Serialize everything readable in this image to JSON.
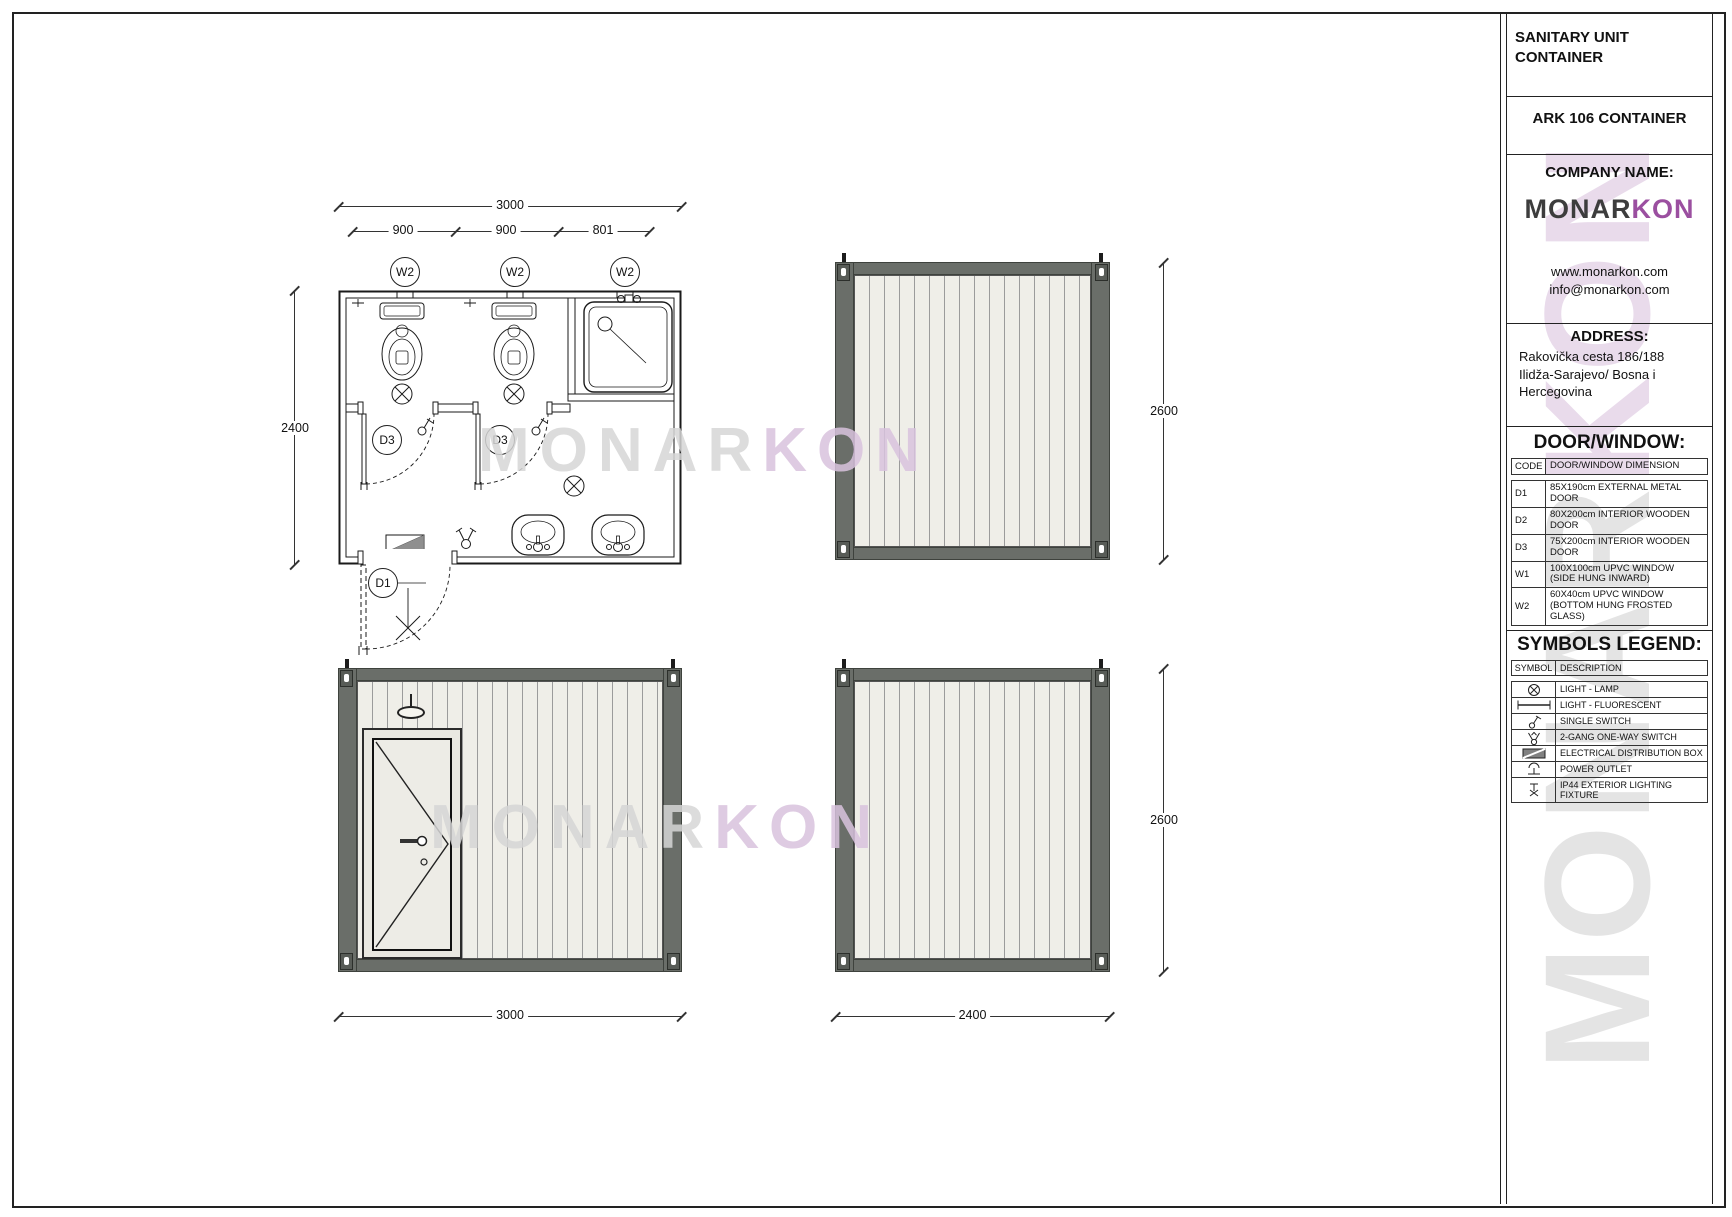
{
  "titleblock": {
    "project_title": "SANITARY UNIT\nCONTAINER",
    "product_title": "ARK 106 CONTAINER",
    "company_label": "COMPANY NAME:",
    "logo": {
      "part1": "MONAR",
      "part2": "KON"
    },
    "website": "www.monarkon.com",
    "email": "info@monarkon.com",
    "address_label": "ADDRESS:",
    "address": "Rakovička cesta 186/188\nIlidža-Sarajevo/ Bosna i\nHercegovina",
    "door_window": {
      "heading": "DOOR/WINDOW:",
      "col_code": "CODE",
      "col_desc": "DOOR/WINDOW DIMENSION",
      "rows": [
        {
          "code": "D1",
          "desc": "85X190cm EXTERNAL METAL DOOR"
        },
        {
          "code": "D2",
          "desc": "80X200cm INTERIOR WOODEN DOOR"
        },
        {
          "code": "D3",
          "desc": "75X200cm INTERIOR WOODEN DOOR"
        },
        {
          "code": "W1",
          "desc": "100X100cm UPVC WINDOW\n(SIDE HUNG INWARD)"
        },
        {
          "code": "W2",
          "desc": "60X40cm UPVC WINDOW\n(BOTTOM HUNG FROSTED GLASS)"
        }
      ]
    },
    "symbols_legend": {
      "heading": "SYMBOLS LEGEND:",
      "col_symbol": "SYMBOL",
      "col_desc": "DESCRIPTION",
      "rows": [
        {
          "symbol": "light-lamp-icon",
          "desc": "LIGHT - LAMP"
        },
        {
          "symbol": "light-fluorescent-icon",
          "desc": "LIGHT - FLUORESCENT"
        },
        {
          "symbol": "single-switch-icon",
          "desc": "SINGLE SWITCH"
        },
        {
          "symbol": "two-gang-one-way-switch-icon",
          "desc": "2-GANG ONE-WAY SWITCH"
        },
        {
          "symbol": "electrical-distribution-box-icon",
          "desc": "ELECTRICAL DISTRIBUTION BOX"
        },
        {
          "symbol": "power-outlet-icon",
          "desc": "POWER OUTLET"
        },
        {
          "symbol": "ip44-exterior-lighting-fixture-icon",
          "desc": "IP44 EXTERIOR LIGHTING FIXTURE"
        }
      ]
    }
  },
  "plan": {
    "dim_total_width": "3000",
    "dim_segments": [
      "900",
      "900",
      "801"
    ],
    "dim_depth": "2400",
    "window_labels": [
      "W2",
      "W2",
      "W2"
    ],
    "door_labels": {
      "d3_left": "D3",
      "d3_right": "D3",
      "d1": "D1"
    }
  },
  "elevations": {
    "right_top_height": "2600",
    "right_bottom_height": "2600",
    "front_width": "3000",
    "side_width": "2400"
  },
  "watermark": {
    "gray_part": "MONAR",
    "purple_part": "KON"
  },
  "colors": {
    "frame_gray": "#6a6e69",
    "panel_fill": "#efeee8",
    "panel_line": "#9b9b9b",
    "watermark_gray": "#d6d6d6",
    "watermark_purple": "#d9c3de",
    "logo_dark": "#3d3d3d",
    "logo_purple": "#9b4fa0",
    "line_black": "#1a1a1a"
  }
}
